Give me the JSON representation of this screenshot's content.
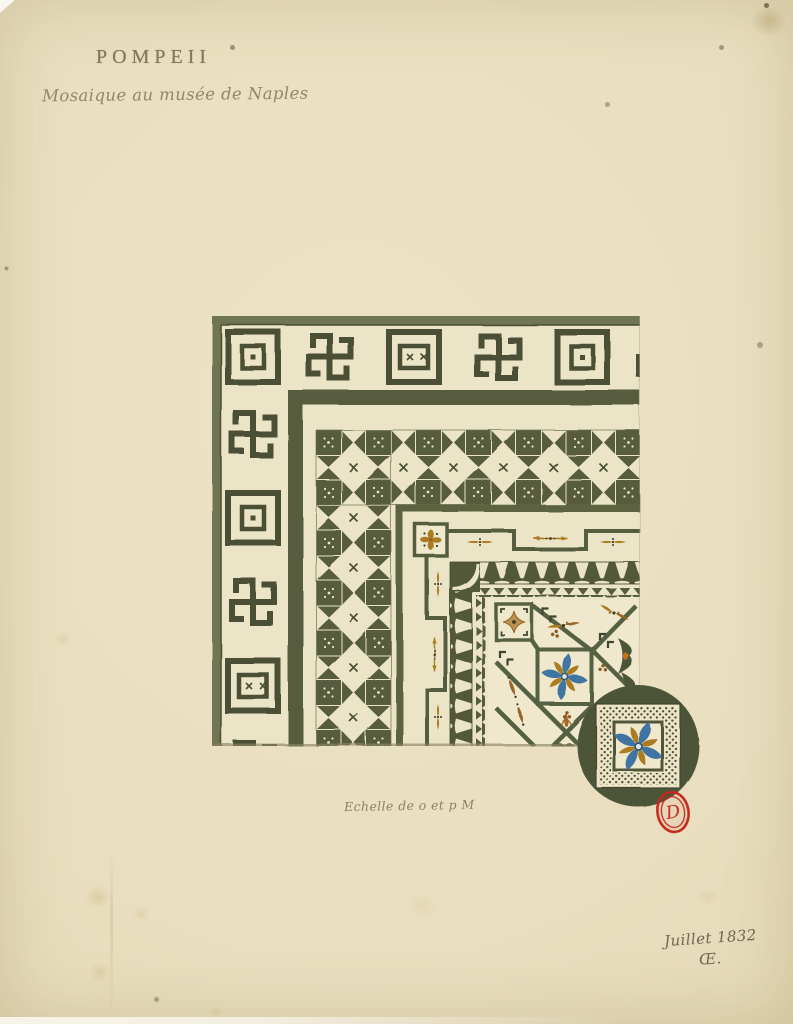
{
  "page": {
    "width": 793,
    "height": 1024,
    "paper_color": "#e9dfc0"
  },
  "header": {
    "title": "POMPEII",
    "subtitle": "Mosaique au musée de Naples"
  },
  "drawing": {
    "subject": "corner of a mosaic pavement, watercolour drawing",
    "bands": [
      "greek-key-meander-border",
      "olive-fillet",
      "checkerboard-hourglass-band",
      "crenellated-fillet-with-darts",
      "tooth-frieze-with-sawtooth",
      "diagonal-lattice-field-with-rosettes"
    ],
    "inset": "circular-magnified-rosette-panel",
    "colors": {
      "dark_olive": "#565b3d",
      "olive_line": "#4b5034",
      "olive_mid": "#6e7452",
      "cream": "#ece4c6",
      "panel_cream": "#efe8cd",
      "gold": "#ab7d23",
      "tan": "#bb8f4f",
      "rust": "#9a5c25",
      "orange": "#c1761c",
      "blue": "#3f75a1",
      "ink": "#8c8168",
      "stamp_red": "#c3291d"
    }
  },
  "scale_label": "Echelle de o et p M",
  "stamp": {
    "letter": "D",
    "color": "#c3291d"
  },
  "signature": {
    "date": "Juillet 1832",
    "monogram": "Œ."
  }
}
